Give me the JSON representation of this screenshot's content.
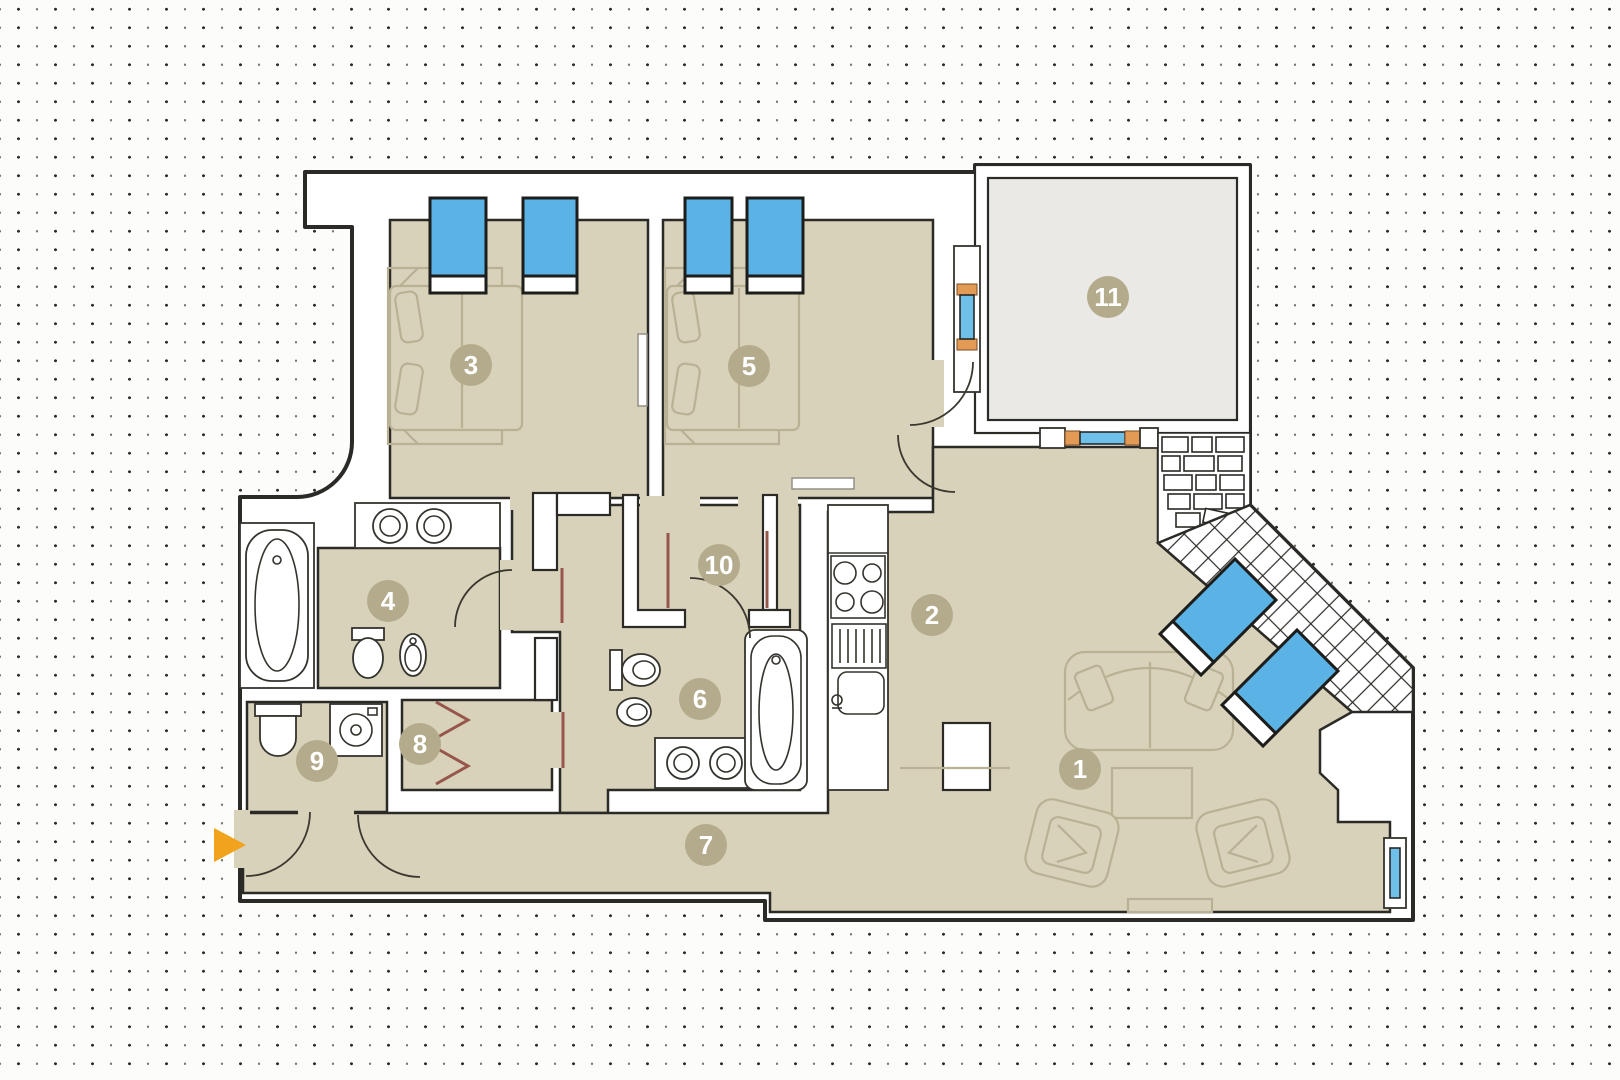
{
  "plan": {
    "title": "apartment-floor-plan",
    "rooms": [
      {
        "id": 1,
        "label": "1"
      },
      {
        "id": 2,
        "label": "2"
      },
      {
        "id": 3,
        "label": "3"
      },
      {
        "id": 4,
        "label": "4"
      },
      {
        "id": 5,
        "label": "5"
      },
      {
        "id": 6,
        "label": "6"
      },
      {
        "id": 7,
        "label": "7"
      },
      {
        "id": 8,
        "label": "8"
      },
      {
        "id": 9,
        "label": "9"
      },
      {
        "id": 10,
        "label": "10"
      },
      {
        "id": 11,
        "label": "11"
      }
    ],
    "entrance": {
      "icon": "entrance-arrow"
    },
    "colors": {
      "floor": "#d8d2bb",
      "wall_line": "#2b2a26",
      "lounger_blue": "#5ab3e4",
      "window_glass_blue": "#6fc0e8",
      "window_frame_orange": "#e39a55",
      "room_badge": "#b4ab8c",
      "badge_text": "#ffffff",
      "terrace_fill": "#eae9e5",
      "door_accent": "#96564c",
      "entrance_arrow_orange": "#f2a31d",
      "furniture_line": "#b9b194",
      "background": "#fcfcfa",
      "dot": "#2d2d2d"
    }
  }
}
